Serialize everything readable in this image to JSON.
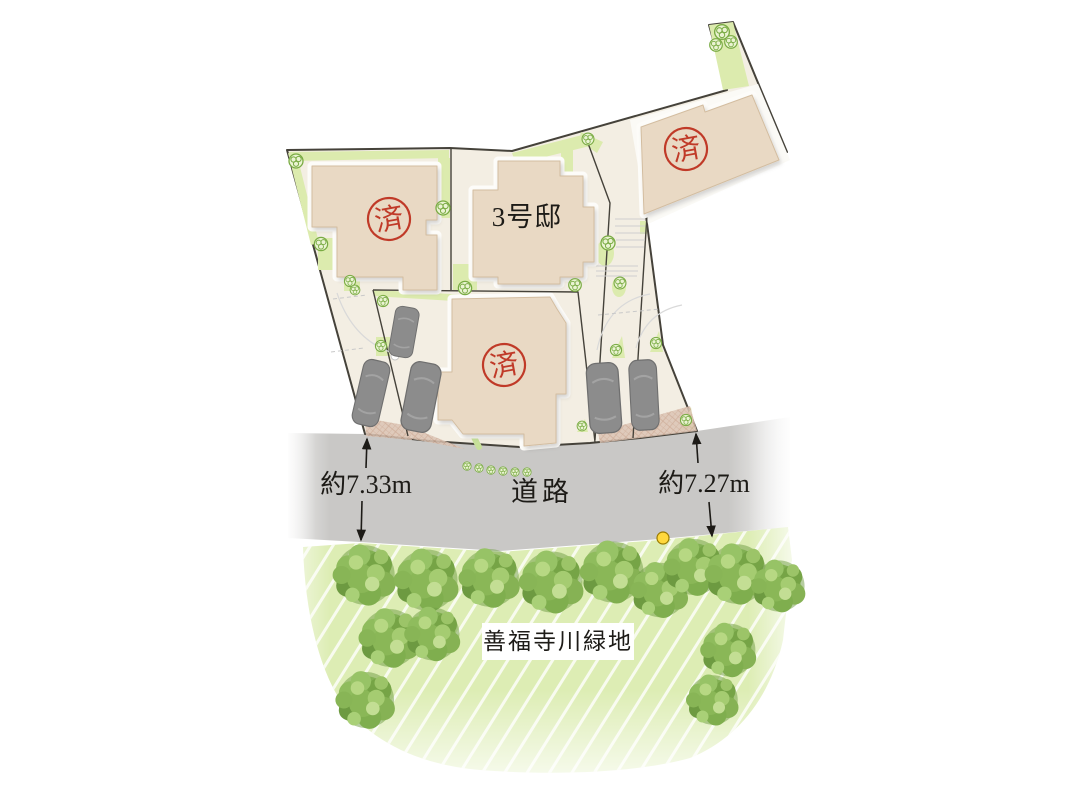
{
  "site_plan": {
    "lots": [
      {
        "id": "upper-left",
        "stamp": "済"
      },
      {
        "id": "upper-right",
        "stamp": "済"
      },
      {
        "id": "no3",
        "label": "3号邸"
      },
      {
        "id": "lower-center",
        "stamp": "済"
      }
    ],
    "road": {
      "label": "道路",
      "frontage_left": "約7.33m",
      "frontage_right": "約7.27m"
    },
    "green_space": {
      "label": "善福寺川緑地"
    },
    "colors": {
      "stamp_red": "#c03a28",
      "marker_yellow": "#ffd83d",
      "building_fill": "#e9d9c4",
      "lot_fill": "#f3eee3",
      "boundary_dark": "#45423a",
      "road_gray": "#c9c8c6",
      "greenery": "#dcebae",
      "green_space_fill": "#ddedb4",
      "tree_green": "#82b053",
      "car_gray": "#8c8c8c"
    },
    "icons": {
      "tree": "tree-icon",
      "shrub": "shrub-icon",
      "car": "car-icon",
      "marker_dot": "utility-marker-dot",
      "dimension_arrow": "dimension-arrow"
    }
  }
}
